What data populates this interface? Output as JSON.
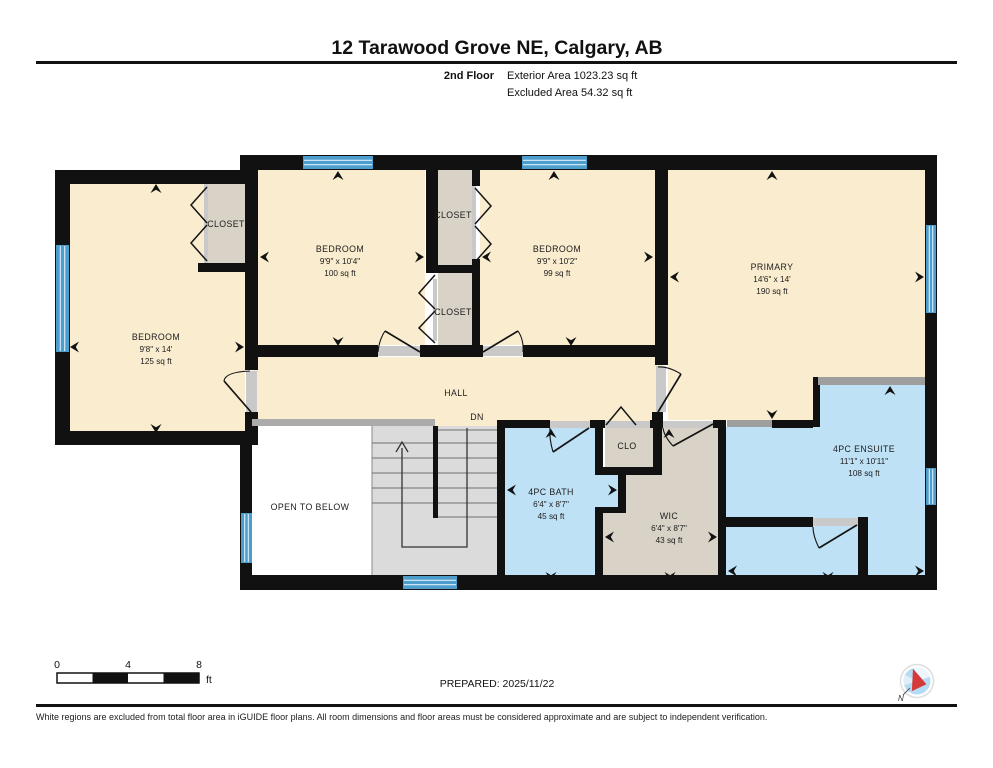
{
  "header": {
    "title": "12 Tarawood Grove NE, Calgary, AB",
    "floor_label": "2nd Floor",
    "exterior_area": "Exterior Area 1023.23 sq ft",
    "excluded_area": "Excluded Area 54.32 sq ft"
  },
  "rooms": {
    "bedroom_left": {
      "name": "BEDROOM",
      "dims": "9'8\" x 14'",
      "area": "125 sq ft"
    },
    "bedroom_mid": {
      "name": "BEDROOM",
      "dims": "9'9\" x 10'4\"",
      "area": "100 sq ft"
    },
    "bedroom_right": {
      "name": "BEDROOM",
      "dims": "9'9\" x 10'2\"",
      "area": "99 sq ft"
    },
    "primary": {
      "name": "PRIMARY",
      "dims": "14'6\" x 14'",
      "area": "190 sq ft"
    },
    "ensuite": {
      "name": "4PC ENSUITE",
      "dims": "11'1\" x 10'11\"",
      "area": "108 sq ft"
    },
    "bath": {
      "name": "4PC BATH",
      "dims": "6'4\" x 8'7\"",
      "area": "45 sq ft"
    },
    "wic": {
      "name": "WIC",
      "dims": "6'4\" x 8'7\"",
      "area": "43 sq ft"
    },
    "closet_left": {
      "name": "CLOSET"
    },
    "closet_top": {
      "name": "CLOSET"
    },
    "closet_bottom": {
      "name": "CLOSET"
    },
    "clo": {
      "name": "CLO"
    },
    "hall": {
      "name": "HALL"
    },
    "stairs_dn": {
      "name": "DN"
    },
    "open_to_below": {
      "name": "OPEN TO BELOW"
    }
  },
  "footer": {
    "scale": {
      "t0": "0",
      "t4": "4",
      "t8": "8",
      "unit": "ft"
    },
    "prepared": "PREPARED: 2025/11/22",
    "compass_north": "N",
    "disclaimer": "White regions are excluded from total floor area in iGUIDE floor plans. All room dimensions and floor areas must be considered approximate and are subject to independent verification."
  },
  "colors": {
    "room_fill": "#FAEDCF",
    "wet_room_fill": "#BFE1F6",
    "closet_fill": "#D9D2C6",
    "stairs_fill": "#DBDBDB",
    "wall": "#111111",
    "window": "#4E9ECD",
    "opening": "#C9C9C9",
    "compass_red": "#D43A3A"
  }
}
